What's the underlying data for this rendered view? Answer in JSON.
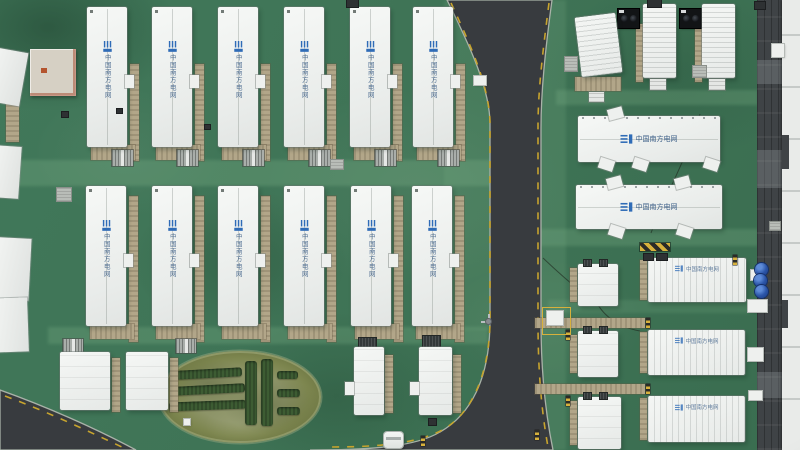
{
  "scene": {
    "kind": "aerial-drone-photo",
    "subject": "Top-down view of a containerized battery energy storage station",
    "operator": "China Southern Power Grid"
  },
  "logo": {
    "text": "中国南方电网",
    "icon_color": "#2f6cb7",
    "text_color": "#3a5d86"
  },
  "palette": {
    "grass": "#3f7456",
    "grass_light": "#82b68c",
    "road": "#383b3f",
    "curb": "#a9b2a8",
    "container_white": "#eff1ef",
    "tan": "#b2a689",
    "dark_strip": "#3f4346",
    "edge_white": "#e9ebe9",
    "hazard_yellow": "#d7b13c",
    "hazard_black": "#2b2b27",
    "drum_blue": "#2b55a8",
    "hedge_green": "#3d5c33",
    "oval_grass": "#7d864f",
    "lane_yellow": "#c7a42e"
  },
  "roads": {
    "main": "M447,0 L552,0 C545,52 541,92 541,128 L541,322 C541,376 546,416 553,450 L310,450 C370,450 415,447 440,432 C470,415 490,380 490,320 L490,124 C490,90 471,48 447,0 Z",
    "corner": "M0,390 C45,406 95,428 136,450 L0,450 Z",
    "dashes": [
      "M451,3 C471,46 489,86 490,122 L490,318 C490,372 473,412 444,429 C420,443 380,447 332,447",
      "M549,3 C543,50 538,90 538,126 L538,322 C538,374 542,414 548,447",
      "M5,396 C48,412 90,432 124,448"
    ],
    "cables": [
      "M543,258 C562,276 580,292 596,301",
      "M700,114 C690,152 664,198 651,233",
      "M596,301 C604,318 622,328 640,331"
    ]
  },
  "bands": [
    [
      0,
      160,
      492,
      26,
      0.28
    ],
    [
      48,
      327,
      440,
      17,
      0.26
    ],
    [
      540,
      0,
      26,
      450,
      0.18
    ],
    [
      444,
      0,
      48,
      330,
      0.14
    ],
    [
      556,
      90,
      202,
      15,
      0.26
    ],
    [
      538,
      229,
      220,
      17,
      0.26
    ],
    [
      548,
      300,
      205,
      13,
      0.18
    ]
  ],
  "containers": {
    "row1": {
      "y": 7,
      "h": 140,
      "w": 40,
      "x": [
        87,
        152,
        218,
        284,
        350,
        413
      ]
    },
    "row2": {
      "y": 186,
      "h": 140,
      "w": 40,
      "x": [
        86,
        152,
        218,
        284,
        351,
        412
      ]
    },
    "bottom_left": [
      [
        60,
        352,
        50,
        58
      ],
      [
        126,
        352,
        42,
        58
      ]
    ],
    "bottom_mid": [
      [
        354,
        347,
        30,
        68
      ],
      [
        419,
        347,
        33,
        68
      ]
    ],
    "small_right": [
      [
        578,
        264,
        40,
        42
      ],
      [
        578,
        331,
        40,
        46
      ],
      [
        578,
        397,
        43,
        52
      ]
    ],
    "ribbed_right": [
      [
        648,
        258,
        98,
        44
      ],
      [
        648,
        330,
        97,
        45
      ],
      [
        648,
        396,
        97,
        46
      ]
    ],
    "h_buildings": [
      {
        "r": [
          578,
          116,
          142,
          46
        ],
        "tabs_top": [
          608
        ],
        "tabs_bottom": [
          599,
          633,
          704
        ]
      },
      {
        "r": [
          576,
          185,
          146,
          44
        ],
        "tabs_top": [
          607,
          675
        ],
        "tabs_bottom": [
          609,
          677
        ]
      }
    ],
    "top_right_pairs": [
      {
        "hvac": [
          618,
          9,
          21,
          19
        ],
        "cont": [
          643,
          4,
          33,
          74
        ],
        "tan": [
          636,
          24,
          7,
          58
        ],
        "steps": [
          650,
          79,
          16,
          11
        ]
      },
      {
        "hvac": [
          680,
          9,
          21,
          19
        ],
        "cont": [
          702,
          4,
          33,
          74
        ],
        "tan": [
          695,
          24,
          7,
          58
        ],
        "steps": [
          709,
          79,
          16,
          11
        ]
      }
    ],
    "rotated_top": {
      "r": [
        578,
        15,
        41,
        60
      ],
      "rot": -7,
      "tan": [
        575,
        77,
        46,
        14
      ],
      "steps": [
        589,
        92,
        15,
        10
      ],
      "graybox": [
        565,
        57,
        12,
        14
      ]
    },
    "edge_left": [
      [
        -8,
        50,
        32,
        54,
        10
      ],
      [
        -6,
        146,
        26,
        52,
        4
      ],
      [
        -4,
        238,
        34,
        62,
        3
      ],
      [
        -4,
        298,
        32,
        54,
        -2
      ]
    ],
    "aux_building": [
      30,
      49,
      46,
      47
    ]
  },
  "garden": {
    "cx": 240,
    "cy": 397,
    "rx": 81,
    "ry": 46,
    "hedges": [
      [
        176,
        369,
        66,
        9,
        -3
      ],
      [
        171,
        385,
        74,
        9,
        -3
      ],
      [
        169,
        401,
        77,
        9,
        -2
      ],
      [
        245,
        361,
        12,
        64,
        0
      ],
      [
        261,
        359,
        12,
        67,
        0
      ],
      [
        277,
        371,
        21,
        8,
        0
      ],
      [
        277,
        389,
        23,
        8,
        0
      ],
      [
        277,
        407,
        23,
        8,
        0
      ]
    ],
    "marker": [
      184,
      419,
      6,
      6
    ]
  },
  "right_edge": {
    "dark": [
      757,
      0,
      26,
      450
    ],
    "white": [
      782,
      0,
      18,
      450
    ],
    "patches": [
      [
        757,
        60,
        26,
        24
      ],
      [
        757,
        150,
        26,
        38
      ],
      [
        757,
        372,
        26,
        26
      ]
    ],
    "notches": [
      [
        782,
        135,
        7,
        34
      ],
      [
        782,
        300,
        6,
        28
      ]
    ]
  },
  "props": {
    "vents_row1_dx": 25,
    "vents_extra": [
      [
        63,
        339,
        20,
        14
      ],
      [
        176,
        339,
        20,
        14
      ]
    ],
    "dark_vents": [
      [
        359,
        338,
        17,
        11
      ],
      [
        423,
        336,
        17,
        11
      ]
    ],
    "blue_drums": [
      [
        761,
        269
      ],
      [
        760,
        280
      ],
      [
        761,
        291
      ]
    ],
    "drum_r": 6,
    "white_boxes": [
      [
        474,
        76,
        12,
        9
      ],
      [
        772,
        44,
        12,
        13
      ],
      [
        751,
        270,
        12,
        10
      ],
      [
        748,
        348,
        15,
        13
      ],
      [
        749,
        391,
        13,
        9
      ],
      [
        748,
        300,
        19,
        12
      ]
    ],
    "gray_boxes": [
      [
        331,
        160,
        12,
        9
      ],
      [
        57,
        188,
        14,
        13
      ],
      [
        693,
        66,
        13,
        11
      ],
      [
        770,
        222,
        10,
        8
      ]
    ],
    "dark_items": [
      [
        347,
        0,
        11,
        7
      ],
      [
        648,
        0,
        13,
        7
      ],
      [
        755,
        2,
        10,
        7
      ],
      [
        62,
        112,
        6,
        5
      ],
      [
        205,
        125,
        5,
        4
      ],
      [
        429,
        419,
        7,
        6
      ],
      [
        117,
        109,
        5,
        4
      ]
    ],
    "hazard_posts": [
      [
        421,
        436
      ],
      [
        535,
        430
      ],
      [
        566,
        330
      ],
      [
        566,
        396
      ],
      [
        646,
        318
      ],
      [
        646,
        384
      ],
      [
        733,
        255
      ]
    ],
    "hazard_strip": [
      640,
      243,
      30,
      8
    ],
    "bolts": [
      [
        644,
        254,
        9,
        6
      ],
      [
        657,
        254,
        10,
        6
      ]
    ],
    "marked_box": {
      "square": [
        542,
        307,
        27,
        26
      ],
      "box": [
        547,
        311,
        16,
        14
      ]
    },
    "lamp": [
      486,
      317
    ],
    "vehicle": [
      384,
      432,
      19,
      16
    ],
    "left_tan": [
      6,
      100,
      13,
      42
    ]
  }
}
